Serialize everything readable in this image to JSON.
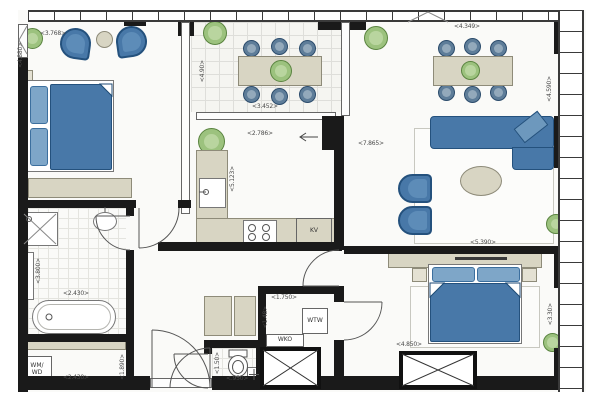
{
  "colors": {
    "wall": "#1a1a1a",
    "furniture_blue": "#4878a8",
    "furniture_blue_light": "#7ea6c8",
    "counter_beige": "#d8d5c3",
    "plant_green": "#9cc27e",
    "floor": "#fafaf8",
    "dimension_text": "#4a4a4a"
  },
  "dimensions": {
    "bedroom1_width": "<3.768>",
    "bedroom1_depth": "<4.880>",
    "balcony_width": "<3.452>",
    "balcony_depth": "<4.90>",
    "kitchen_width": "<2.786>",
    "kitchen_depth": "<5.123>",
    "dining_width": "<4.349>",
    "living_length": "<7.865>",
    "living_width": "<5.390>",
    "living_depth_right": "<4.590>",
    "bathroom_width": "<2.430>",
    "bathroom_depth": "<3.800>",
    "laundry_width": "<2.430>",
    "laundry_depth": "<1.890>",
    "tech_room_width": "<1.750>",
    "tech_room_depth": "<1.48>",
    "toilet_width": "<.950>",
    "toilet_depth": "<1.50>",
    "bedroom2_width": "<4.850>",
    "bedroom2_depth": "<3.30>"
  },
  "fixtures": {
    "fridge": "KV",
    "heat_recovery_unit": "WTW",
    "heat_cold_storage": "WKO",
    "washer_dryer_line1": "WM/",
    "washer_dryer_line2": "WD"
  }
}
